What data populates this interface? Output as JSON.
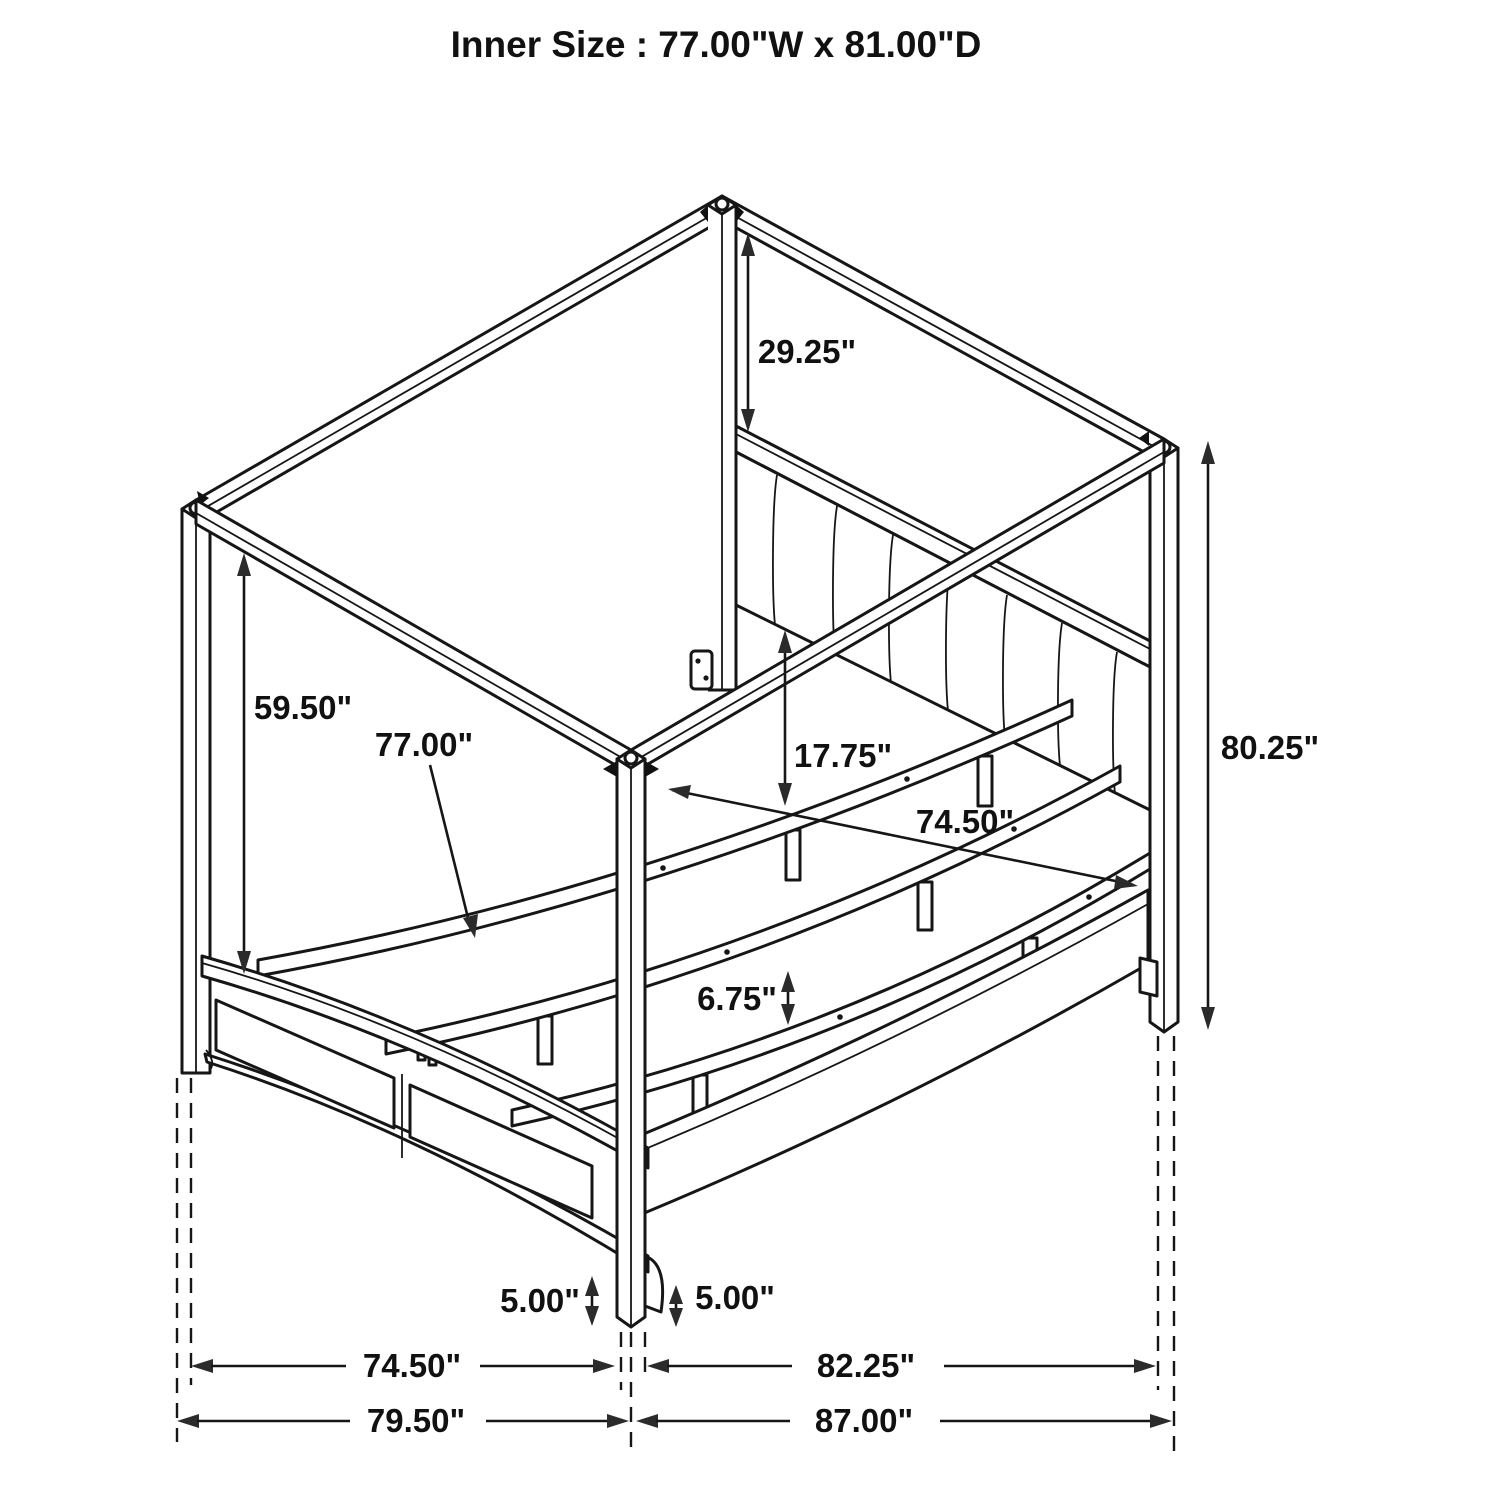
{
  "title": "Inner Size : 77.00\"W x 81.00\"D",
  "dims": {
    "headboard_to_canopy": "29.25\"",
    "post_clearance": "59.50\"",
    "slat_length": "77.00\"",
    "headboard_panel_height": "17.75\"",
    "side_rail_inner": "74.50\"",
    "overall_height": "80.25\"",
    "slat_leg_height": "6.75\"",
    "foot_height_left": "5.00\"",
    "foot_height_right": "5.00\"",
    "footboard_span_inner": "74.50\"",
    "side_span_inner": "82.25\"",
    "footboard_span_outer": "79.50\"",
    "side_span_outer": "87.00\""
  }
}
